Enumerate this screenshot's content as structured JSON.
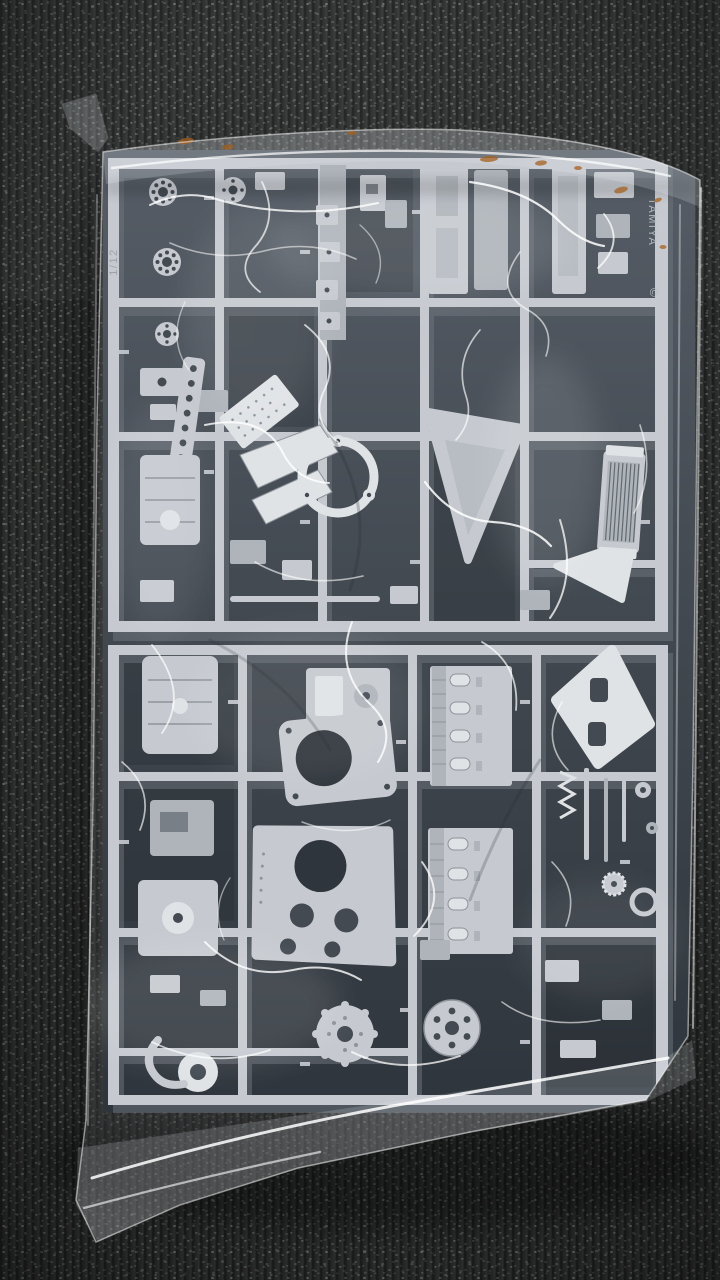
{
  "meta": {
    "type": "photograph",
    "subject": "Light-grey plastic model kit sprues sealed in a clear crumpled poly bag, lying on dark loop-pile carpet",
    "orientation": "portrait"
  },
  "photo": {
    "background": {
      "surface": "loop-pile carpet",
      "color_name": "dark charcoal grey with light speckles"
    },
    "bag": {
      "material": "clear polyethylene",
      "state": "sealed, crumpled, strong white glossy reflections",
      "stains": "rust-coloured smudges along the top rolled edge"
    },
    "sprues": {
      "material": "injection-moulded polystyrene",
      "color_name": "light grey",
      "runner_count_visible": 2,
      "parts_visible": [
        "wheel hubs",
        "bearing carriers",
        "chassis brackets",
        "cylinder heads",
        "bell-housing plate",
        "clutch-housing plate",
        "circular gasket ring",
        "triangular mounting plates",
        "radiator core",
        "pulleys",
        "round covers",
        "grommet",
        "shafts",
        "coil spring",
        "gears"
      ]
    },
    "molded_text": {
      "brand": "TAMIYA",
      "copyright_mark": "©",
      "scale_mark": "1/12"
    }
  },
  "colors": {
    "carpet_base": "#2d2f2e",
    "carpet_speckle": "#767b76",
    "carpet_speckle_dim": "#515652",
    "part_gray": "#c6cad0",
    "part_light": "#e0e3e6",
    "part_mid": "#aeb4ba",
    "part_shadow": "#8d939b",
    "cavity_dark": "#434a52",
    "cavity_deep": "#2f353c",
    "highlight": "#ffffff",
    "rust": "#a5601f"
  }
}
